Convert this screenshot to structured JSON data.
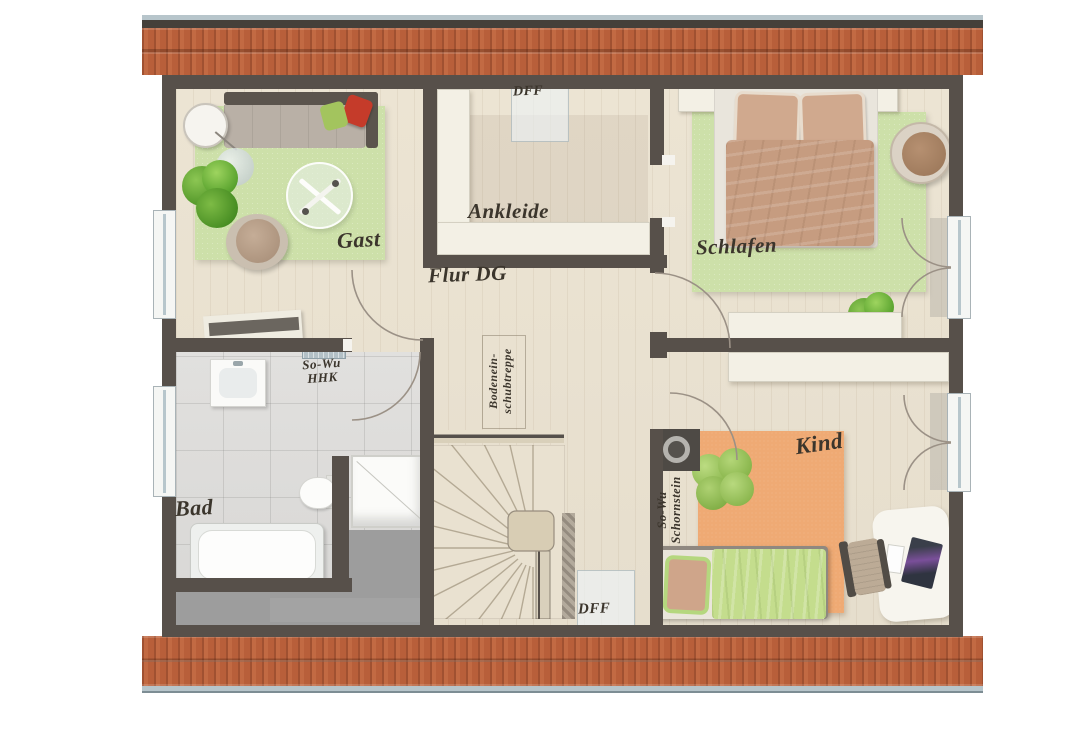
{
  "plan": {
    "title": "attic-floor-plan",
    "rooms": {
      "gast": "Gast",
      "ankleide": "Ankleide",
      "flur": "Flur DG",
      "schlafen": "Schlafen",
      "bad": "Bad",
      "kind": "Kind"
    },
    "annotations": {
      "dff_top": "DFF",
      "dff_bottom": "DFF",
      "hhk_line1": "So-Wu",
      "hhk_line2": "HHK",
      "schornstein_line1": "So-Wu",
      "schornstein_line2": "Schornstein",
      "treppe_line1": "Bodenein-",
      "treppe_line2": "schubtreppe"
    },
    "colors": {
      "wall": "#57504a",
      "wood_floor": "#ece4d3",
      "tile_floor": "#dedddb",
      "rug_green": "#cde0a9",
      "rug_orange": "#efaa74",
      "roof_tile": "#bc6440",
      "gutter": "#b7c5cb",
      "attic_gray": "#9d9d9d",
      "furniture_cream": "#f3f0e5",
      "label_text": "#3b352c",
      "bed_blanket_tan": "#c69c80",
      "kid_blanket_green": "#c4dd8d",
      "pillow_red": "#c53b2a",
      "pillow_green": "#a3c45e"
    }
  }
}
